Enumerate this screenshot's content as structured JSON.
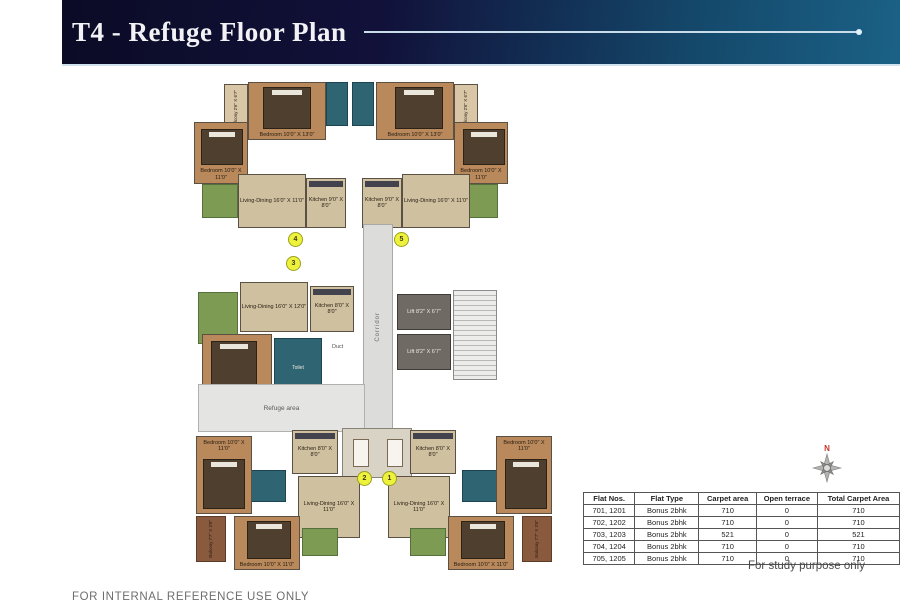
{
  "header": {
    "title": "T4 - Refuge Floor Plan"
  },
  "plan": {
    "labels": {
      "bedroom_10x13": "Bedroom 10'0\" X 13'0\"",
      "bedroom_10x11": "Bedroom 10'0\" X 11'0\"",
      "living_dining_16x11": "Living-Dining 16'0\" X 11'0\"",
      "living_dining_16x12": "Living-Dining 16'0\" X 12'0\"",
      "kitchen_9x8": "Kitchen 9'0\" X 8'0\"",
      "kitchen_8x8": "Kitchen 8'0\" X 8'0\"",
      "lift": "Lift 8'2\" X 6'7\"",
      "corridor": "Corridor",
      "refuge_area": "Refuge area",
      "duct": "Duct",
      "toilet": "Toilet",
      "balcony_77x36": "Balcony 7'7\" X 3'6\"",
      "balcony_26x67": "Balcony 2'6\" X 6'7\""
    },
    "unit_markers": [
      "1",
      "2",
      "3",
      "4",
      "5"
    ]
  },
  "table": {
    "headers": [
      "Flat Nos.",
      "Flat Type",
      "Carpet area",
      "Open terrace",
      "Total Carpet Area"
    ],
    "rows": [
      [
        "701, 1201",
        "Bonus 2bhk",
        "710",
        "0",
        "710"
      ],
      [
        "702, 1202",
        "Bonus 2bhk",
        "710",
        "0",
        "710"
      ],
      [
        "703, 1203",
        "Bonus 2bhk",
        "521",
        "0",
        "521"
      ],
      [
        "704, 1204",
        "Bonus 2bhk",
        "710",
        "0",
        "710"
      ],
      [
        "705, 1205",
        "Bonus 2bhk",
        "710",
        "0",
        "710"
      ]
    ]
  },
  "compass": {
    "north_label": "N"
  },
  "notes": {
    "study": "For study purpose only",
    "internal": "FOR INTERNAL REFERENCE USE ONLY"
  },
  "colors": {
    "header_navy": "#0b0b26",
    "header_teal": "#1b6186",
    "wood_floor": "#b9895c",
    "living_tan": "#cfc0a0",
    "bath_teal": "#2f6472",
    "balcony_green": "#7d9b53",
    "lift_gray": "#6f6a64",
    "marker_yellow": "#eef23d",
    "north_red": "#c03a2b"
  }
}
